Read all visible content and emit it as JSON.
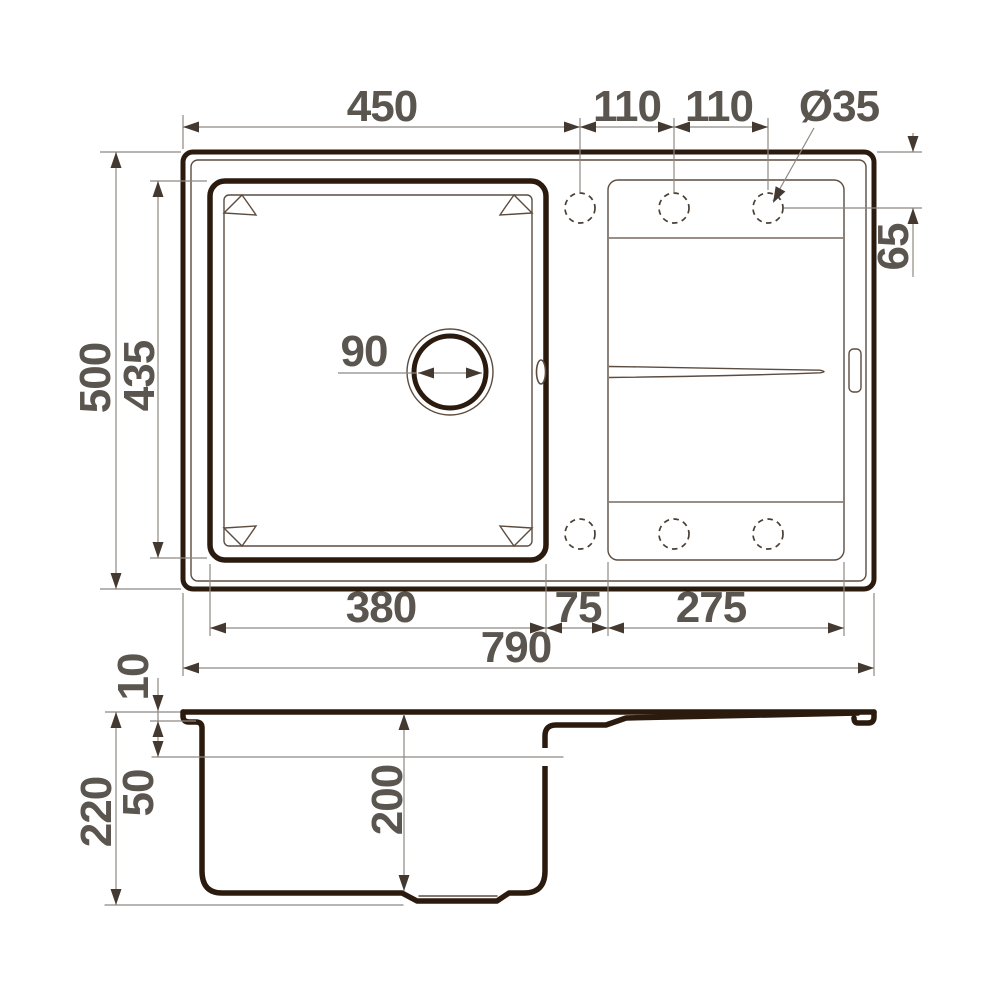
{
  "drawing": {
    "title": "sink-technical-drawing",
    "units": "mm",
    "colors": {
      "thick_line": "#2b1a0e",
      "thin_line": "#5c4c40",
      "dim_line": "#8e8882",
      "dim_text": "#5b554f"
    },
    "dims": {
      "top_width": "450",
      "hole_pitch_1": "110",
      "hole_pitch_2": "110",
      "hole_diameter": "Ø35",
      "overall_depth": "500",
      "bowl_outer_depth": "435",
      "hole_edge_offset": "65",
      "drain_hole": "90",
      "bowl_width": "380",
      "divider_width": "75",
      "drainboard_width": "275",
      "overall_width": "790",
      "rim_height": "10",
      "rim_to_board_drop": "50",
      "overall_height": "220",
      "bowl_depth": "200"
    }
  }
}
